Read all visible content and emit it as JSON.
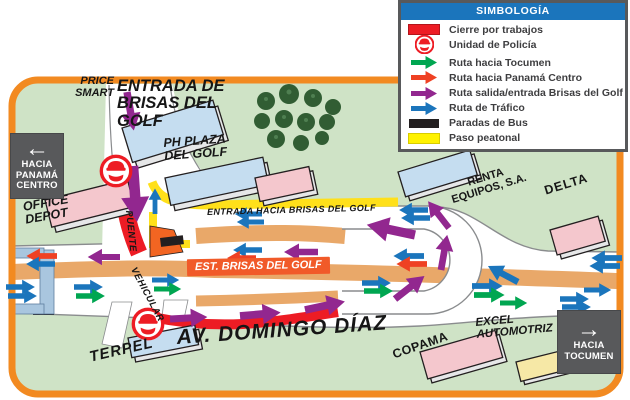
{
  "legend": {
    "title": "SIMBOLOGÍA",
    "items": [
      {
        "label": "Cierre por trabajos",
        "icon": "red-swatch",
        "color": "#ed1c24"
      },
      {
        "label": "Unidad de Policía",
        "icon": "police-badge",
        "color": "#ed1c24"
      },
      {
        "label": "Ruta hacia Tocumen",
        "icon": "green-arrow",
        "color": "#00a651"
      },
      {
        "label": "Ruta hacia Panamá Centro",
        "icon": "red-arrow",
        "color": "#ef4123"
      },
      {
        "label": "Ruta salida/entrada Brisas del Golf",
        "icon": "purple-arrow",
        "color": "#92278f"
      },
      {
        "label": "Ruta de Tráfico",
        "icon": "blue-arrow",
        "color": "#1b75bc"
      },
      {
        "label": "Paradas de Bus",
        "icon": "black-swatch",
        "color": "#231f20"
      },
      {
        "label": "Paso peatonal",
        "icon": "yellow-swatch",
        "color": "#fff200"
      }
    ]
  },
  "signs": {
    "panama_centro": "HACIA\nPANAMÁ\nCENTRO",
    "panama_arrow": "←",
    "tocumen": "HACIA\nTOCUMEN",
    "tocumen_arrow": "→"
  },
  "labels": {
    "price_smart": "PRICE\nSMART",
    "entrada_brisas": "ENTRADA DE\nBRISAS DEL\nGOLF",
    "ph_plaza": "PH PLAZA\nDEL GOLF",
    "office_depot": "OFFICE\nDEPOT",
    "puente": "PUENTE",
    "vehicular": "VEHICULAR",
    "entrada_hacia": "ENTRADA HACIA BRISAS DEL GOLF",
    "est_brisas": "EST. BRISAS DEL GOLF",
    "av_domingo": "AV. DOMINGO DÍAZ",
    "terpel": "TERPEL",
    "renta_equipos": "RENTA\nEQUIPOS, S.A.",
    "delta": "DELTA",
    "excel": "EXCEL\nAUTOMOTRIZ",
    "copama": "COPAMA"
  },
  "map_colors": {
    "background_green": "#cfe3c6",
    "border_orange": "#f28a21",
    "median_tan": "#e9a869",
    "closure_red": "#ed1c24",
    "pedestrian_yellow": "#ffe01a",
    "bus_stop_black": "#231f20",
    "legend_header_blue": "#1b75bc",
    "sign_gray": "#58595b"
  }
}
